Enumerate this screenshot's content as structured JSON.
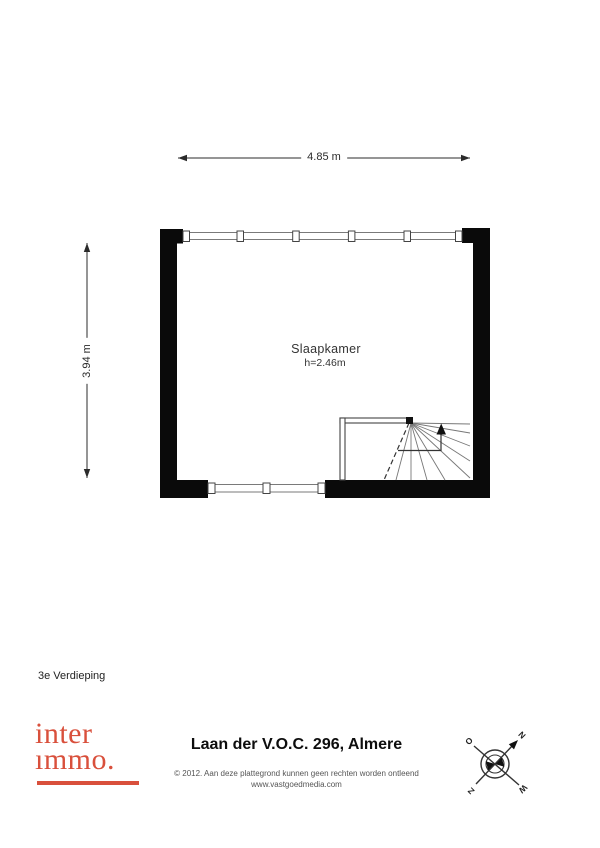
{
  "floor_plan": {
    "room_label": "Slaapkamer",
    "room_height": "h=2.46m",
    "dim_width": "4.85 m",
    "dim_depth": "3.94 m",
    "floor_label": "3e Verdieping",
    "wall_color": "#0a0a0a"
  },
  "footer": {
    "logo_line1": "inter",
    "logo_line2": "ımmo.",
    "logo_color": "#d9503c",
    "address_title": "Laan der V.O.C. 296, Almere",
    "copyright": "© 2012. Aan deze plattegrond kunnen geen rechten worden ontleend",
    "website": "www.vastgoedmedia.com"
  },
  "compass": {
    "letters": {
      "top_right": "N",
      "top_left": "O",
      "bottom_left": "Z",
      "bottom_right": "W"
    }
  }
}
